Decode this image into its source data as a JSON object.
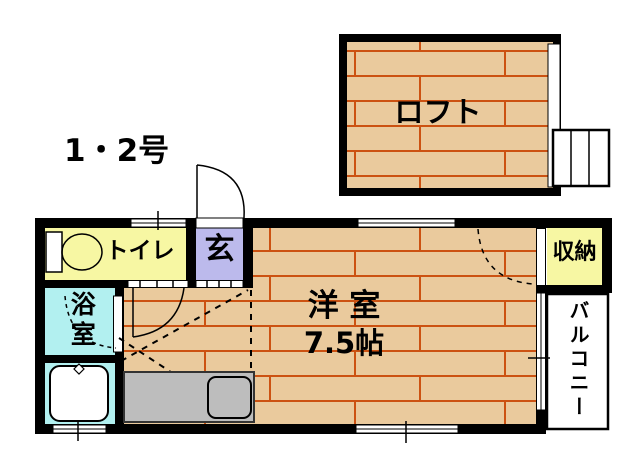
{
  "unit_label": "1・2号",
  "rooms": {
    "loft": "ロフト",
    "toilet": "トイレ",
    "entrance": "玄",
    "bath": "浴室",
    "western_room": "洋 室",
    "western_room_size": "7.5帖",
    "storage": "収納",
    "balcony": "バルコニー"
  },
  "colors": {
    "wall": "#000000",
    "wood_floor": "#EACA9D",
    "wood_line": "#CC5212",
    "toilet_room": "#F7F7A3",
    "entrance_room": "#BCBAEC",
    "bath_room": "#B2F0F0",
    "storage_room": "#F7F7A3",
    "balcony_floor": "#FFFFFF",
    "kitchen_counter": "#BDBDBD",
    "fixture_fill": "#FFFFFF",
    "text": "#000000"
  }
}
